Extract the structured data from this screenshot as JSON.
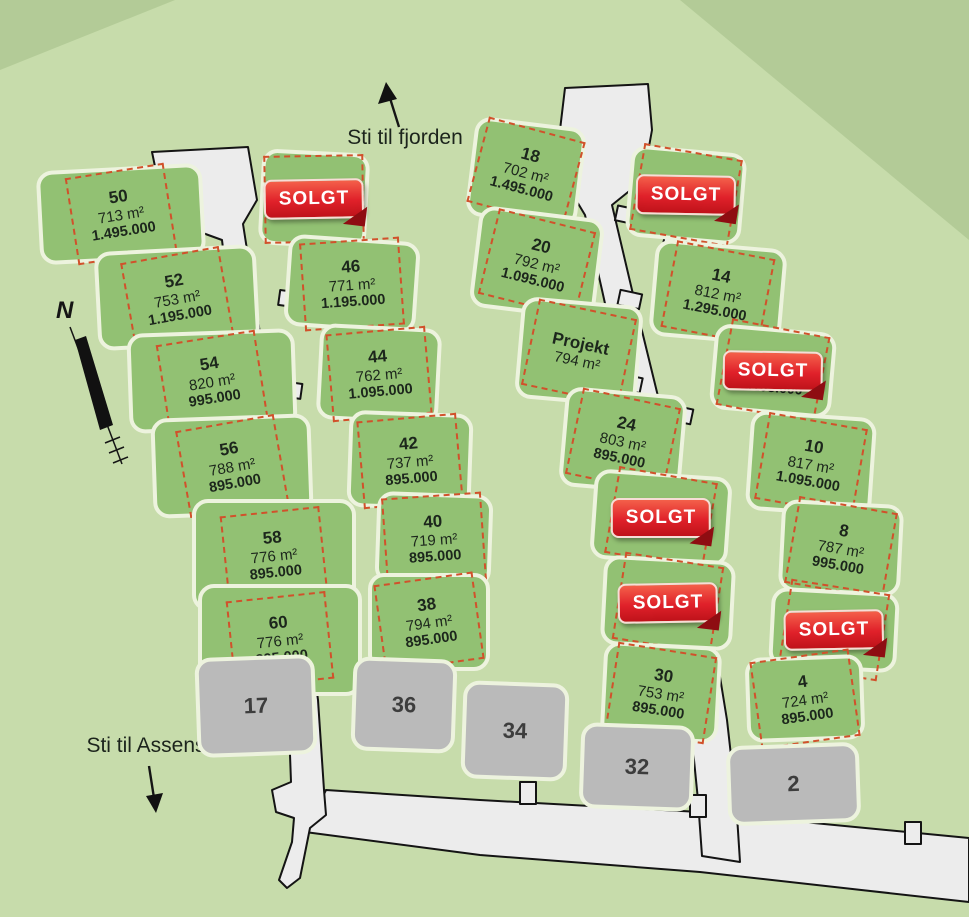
{
  "map": {
    "labels": {
      "fjord": "Sti til fjorden",
      "assens": "Sti til Assens",
      "north": "N"
    },
    "badge_label": "SOLGT",
    "colors": {
      "background": "#c7dcab",
      "corner_shade": "#b3cb97",
      "plot_green": "#92c173",
      "plot_gray": "#bababa",
      "road": "#ececec",
      "dashed_border": "#d1512b",
      "badge_red": "#d8232a",
      "text_dark": "#1c261c"
    },
    "plots": [
      {
        "number": "50",
        "area": "713 m²",
        "price": "1.495.000",
        "status": "available",
        "x": 38,
        "y": 167,
        "w": 166,
        "h": 94,
        "rot": -3,
        "box_rot": -6
      },
      {
        "number": "52",
        "area": "753 m²",
        "price": "1.195.000",
        "status": "available",
        "x": 96,
        "y": 248,
        "w": 162,
        "h": 99,
        "rot": -3,
        "box_rot": -7
      },
      {
        "number": "54",
        "area": "820 m²",
        "price": "995.000",
        "status": "available",
        "x": 128,
        "y": 331,
        "w": 168,
        "h": 100,
        "rot": -2,
        "box_rot": -7
      },
      {
        "number": "56",
        "area": "788 m²",
        "price": "895.000",
        "status": "available",
        "x": 152,
        "y": 416,
        "w": 160,
        "h": 100,
        "rot": -2,
        "box_rot": -8
      },
      {
        "number": "58",
        "area": "776 m²",
        "price": "895.000",
        "status": "available",
        "x": 192,
        "y": 499,
        "w": 164,
        "h": 112,
        "rot": 0,
        "box_rot": -6
      },
      {
        "number": "60",
        "area": "776 m²",
        "price": "895.000",
        "status": "available",
        "x": 198,
        "y": 584,
        "w": 164,
        "h": 112,
        "rot": 0,
        "box_rot": -6
      },
      {
        "number": "17",
        "status": "gray",
        "x": 196,
        "y": 656,
        "w": 120,
        "h": 100,
        "rot": -2
      },
      {
        "status": "sold",
        "x": 260,
        "y": 151,
        "w": 108,
        "h": 96,
        "rot": 3,
        "box_rot": -4
      },
      {
        "number": "46",
        "area": "771 m²",
        "price": "1.195.000",
        "status": "available",
        "x": 286,
        "y": 238,
        "w": 132,
        "h": 92,
        "rot": 4,
        "box_rot": -8
      },
      {
        "number": "44",
        "area": "762 m²",
        "price": "1.095.000",
        "status": "available",
        "x": 318,
        "y": 326,
        "w": 122,
        "h": 96,
        "rot": 3,
        "box_rot": -8
      },
      {
        "number": "42",
        "area": "737 m²",
        "price": "895.000",
        "status": "available",
        "x": 348,
        "y": 412,
        "w": 124,
        "h": 97,
        "rot": 2,
        "box_rot": -7
      },
      {
        "number": "40",
        "area": "719 m²",
        "price": "895.000",
        "status": "available",
        "x": 376,
        "y": 493,
        "w": 116,
        "h": 92,
        "rot": 2,
        "box_rot": -6
      },
      {
        "number": "38",
        "area": "794 m²",
        "price": "895.000",
        "status": "available",
        "x": 368,
        "y": 573,
        "w": 122,
        "h": 98,
        "rot": 0,
        "box_rot": -8
      },
      {
        "number": "36",
        "status": "gray",
        "x": 352,
        "y": 658,
        "w": 104,
        "h": 94,
        "rot": 2
      },
      {
        "number": "34",
        "status": "gray",
        "x": 462,
        "y": 682,
        "w": 106,
        "h": 98,
        "rot": 2
      },
      {
        "number": "18",
        "area": "702 m²",
        "price": "1.495.000",
        "status": "available",
        "x": 470,
        "y": 122,
        "w": 112,
        "h": 100,
        "rot": 7,
        "box_rot": 8
      },
      {
        "number": "20",
        "area": "792 m²",
        "price": "1.095.000",
        "status": "available",
        "x": 474,
        "y": 212,
        "w": 126,
        "h": 102,
        "rot": 7,
        "box_rot": 7
      },
      {
        "number": "Projekt",
        "area": "794 m²",
        "status": "project",
        "x": 518,
        "y": 301,
        "w": 122,
        "h": 102,
        "rot": 5,
        "box_rot": 7
      },
      {
        "number": "24",
        "area": "803 m²",
        "price": "895.000",
        "status": "available",
        "x": 562,
        "y": 391,
        "w": 122,
        "h": 100,
        "rot": 5,
        "box_rot": 7
      },
      {
        "status": "sold",
        "x": 592,
        "y": 473,
        "w": 138,
        "h": 90,
        "rot": 4,
        "box_rot": 6
      },
      {
        "status": "sold",
        "x": 602,
        "y": 558,
        "w": 132,
        "h": 90,
        "rot": 3,
        "box_rot": 6
      },
      {
        "number": "30",
        "area": "753 m²",
        "price": "895.000",
        "status": "available",
        "x": 602,
        "y": 644,
        "w": 118,
        "h": 97,
        "rot": 3,
        "box_rot": 6
      },
      {
        "number": "32",
        "status": "gray",
        "x": 580,
        "y": 724,
        "w": 114,
        "h": 86,
        "rot": 2
      },
      {
        "status": "sold",
        "x": 628,
        "y": 149,
        "w": 116,
        "h": 92,
        "rot": 5,
        "box_rot": 5
      },
      {
        "number": "14",
        "area": "812 m²",
        "price": "1.295.000",
        "status": "available",
        "x": 652,
        "y": 244,
        "w": 132,
        "h": 97,
        "rot": 5,
        "box_rot": 6
      },
      {
        "status": "sold",
        "sub_price": "1.195.000",
        "x": 712,
        "y": 328,
        "w": 122,
        "h": 86,
        "rot": 5,
        "box_rot": 6
      },
      {
        "number": "10",
        "area": "817 m²",
        "price": "1.095.000",
        "status": "available",
        "x": 748,
        "y": 414,
        "w": 126,
        "h": 100,
        "rot": 4,
        "box_rot": 6
      },
      {
        "number": "8",
        "area": "787 m²",
        "price": "995.000",
        "status": "available",
        "x": 780,
        "y": 502,
        "w": 122,
        "h": 92,
        "rot": 3,
        "box_rot": 7
      },
      {
        "status": "sold",
        "x": 770,
        "y": 590,
        "w": 128,
        "h": 80,
        "rot": 3,
        "box_rot": 6
      },
      {
        "number": "4",
        "area": "724 m²",
        "price": "895.000",
        "status": "available",
        "x": 746,
        "y": 656,
        "w": 118,
        "h": 85,
        "rot": -2,
        "box_rot": -6
      },
      {
        "number": "2",
        "status": "gray",
        "x": 727,
        "y": 744,
        "w": 133,
        "h": 80,
        "rot": -2
      }
    ]
  }
}
